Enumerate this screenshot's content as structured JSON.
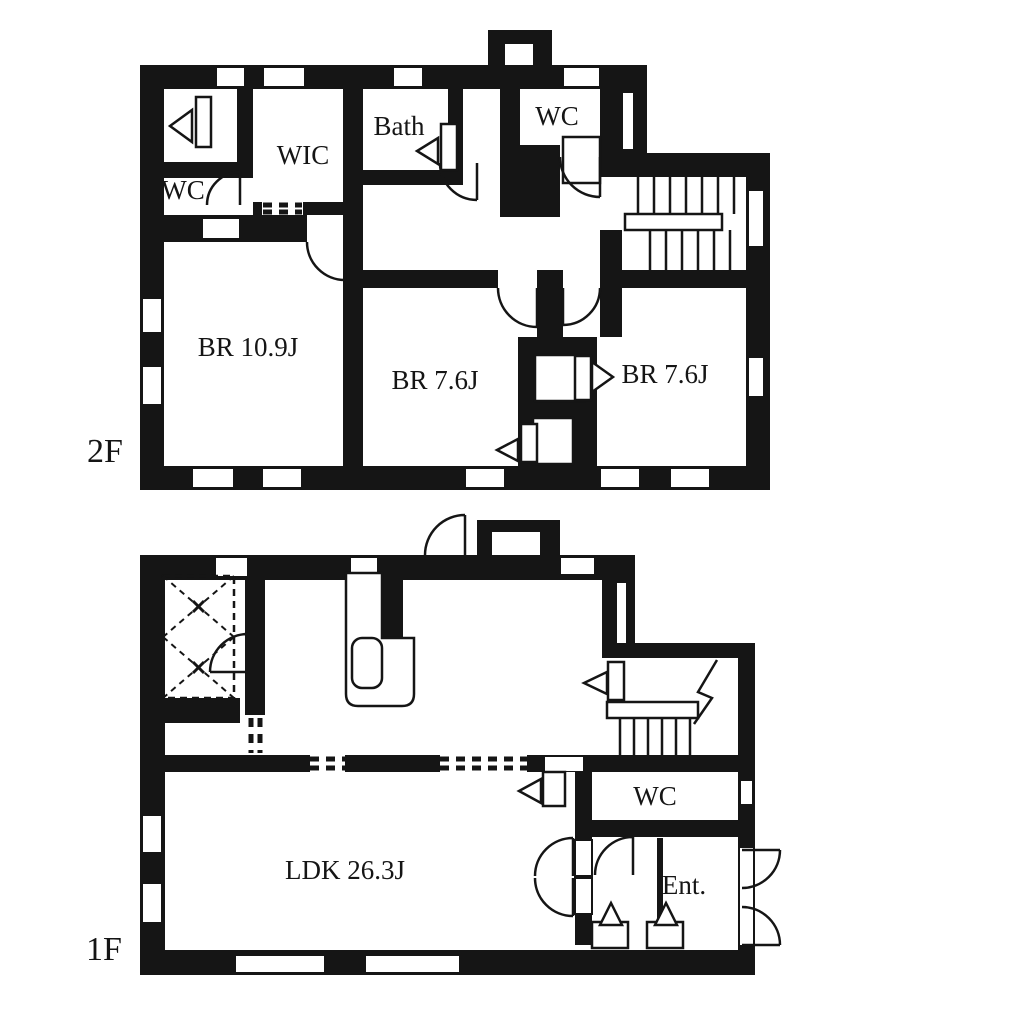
{
  "colors": {
    "ink": "#151515",
    "background": "#ffffff"
  },
  "floors": {
    "f2": {
      "label": "2F",
      "rooms": {
        "wc_side": "WC",
        "wic": "WIC",
        "bath": "Bath",
        "wc_top": "WC",
        "br_main": "BR 10.9J",
        "br_mid": "BR 7.6J",
        "br_right": "BR 7.6J"
      }
    },
    "f1": {
      "label": "1F",
      "rooms": {
        "ldk": "LDK 26.3J",
        "wc": "WC",
        "entrance": "Ent."
      }
    }
  }
}
